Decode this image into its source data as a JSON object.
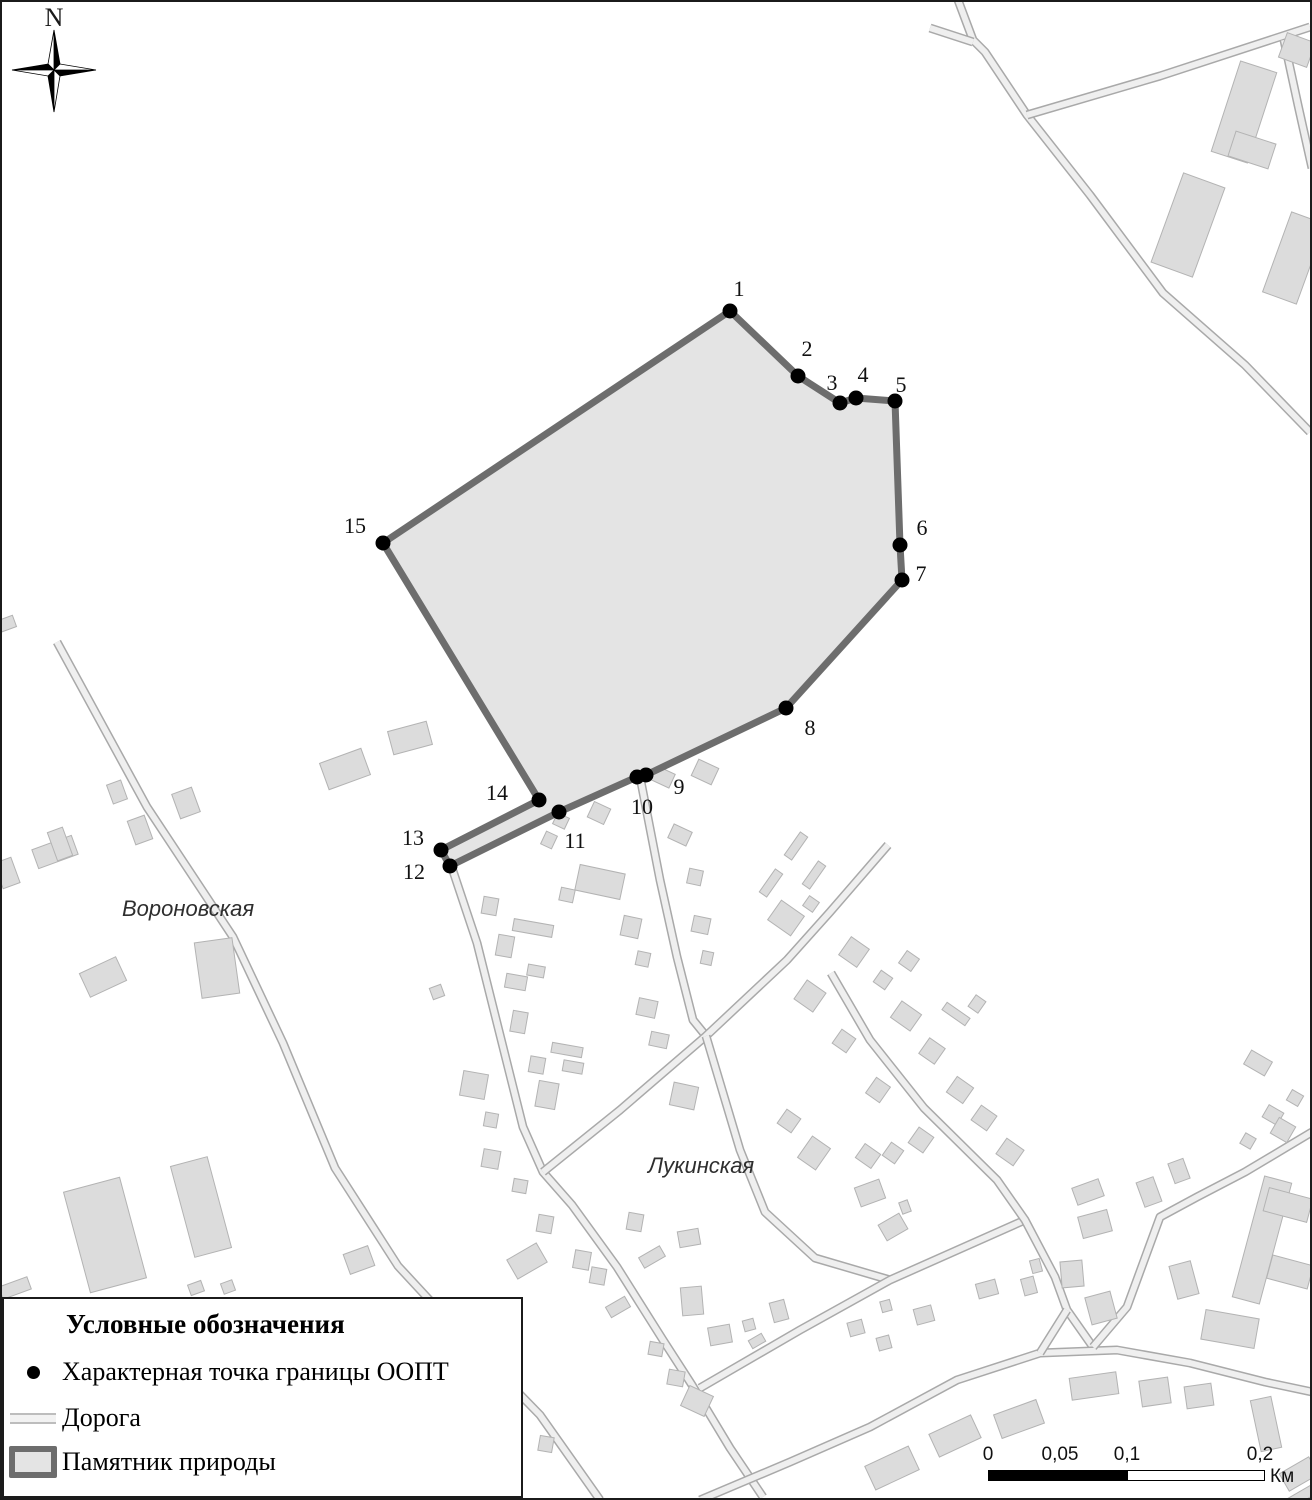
{
  "map": {
    "compass_label": "N",
    "colors": {
      "area_fill": "#e4e4e4",
      "area_stroke": "#6d6d6d",
      "road_casing": "#a9a9a9",
      "road_fill": "#efefef",
      "building_fill": "#dcdcdc",
      "building_stroke": "#b3b3b3",
      "point_dot": "#000000"
    },
    "street_labels": [
      {
        "text": "Вороновская",
        "x": 122,
        "y": 916
      },
      {
        "text": "Лукинская",
        "x": 648,
        "y": 1173
      }
    ],
    "boundary_points": [
      {
        "n": "1",
        "x": 730,
        "y": 311,
        "lx": 739,
        "ly": 296
      },
      {
        "n": "2",
        "x": 798,
        "y": 376,
        "lx": 807,
        "ly": 356
      },
      {
        "n": "3",
        "x": 840,
        "y": 403,
        "lx": 832,
        "ly": 390
      },
      {
        "n": "4",
        "x": 856,
        "y": 398,
        "lx": 863,
        "ly": 382
      },
      {
        "n": "5",
        "x": 895,
        "y": 401,
        "lx": 901,
        "ly": 392
      },
      {
        "n": "6",
        "x": 900,
        "y": 545,
        "lx": 922,
        "ly": 535
      },
      {
        "n": "7",
        "x": 902,
        "y": 580,
        "lx": 921,
        "ly": 581
      },
      {
        "n": "8",
        "x": 786,
        "y": 708,
        "lx": 810,
        "ly": 735
      },
      {
        "n": "9",
        "x": 646,
        "y": 775,
        "lx": 679,
        "ly": 794
      },
      {
        "n": "10",
        "x": 637,
        "y": 777,
        "lx": 642,
        "ly": 814
      },
      {
        "n": "11",
        "x": 559,
        "y": 812,
        "lx": 575,
        "ly": 848
      },
      {
        "n": "12",
        "x": 450,
        "y": 866,
        "lx": 414,
        "ly": 879
      },
      {
        "n": "13",
        "x": 441,
        "y": 850,
        "lx": 413,
        "ly": 845
      },
      {
        "n": "14",
        "x": 539,
        "y": 800,
        "lx": 497,
        "ly": 800
      },
      {
        "n": "15",
        "x": 383,
        "y": 543,
        "lx": 355,
        "ly": 533
      }
    ],
    "roads": [
      [
        [
          958,
          0
        ],
        [
          973,
          40
        ],
        [
          985,
          52
        ],
        [
          1027,
          115
        ],
        [
          1090,
          195
        ],
        [
          1163,
          293
        ],
        [
          1245,
          365
        ],
        [
          1310,
          432
        ]
      ],
      [
        [
          930,
          28
        ],
        [
          973,
          42
        ]
      ],
      [
        [
          1027,
          115
        ],
        [
          1160,
          76
        ],
        [
          1310,
          27
        ]
      ],
      [
        [
          1284,
          40
        ],
        [
          1298,
          105
        ],
        [
          1312,
          168
        ]
      ],
      [
        [
          57,
          642
        ],
        [
          147,
          807
        ],
        [
          233,
          937
        ],
        [
          283,
          1043
        ],
        [
          335,
          1168
        ],
        [
          398,
          1266
        ],
        [
          460,
          1333
        ],
        [
          540,
          1415
        ],
        [
          600,
          1500
        ]
      ],
      [
        [
          452,
          868
        ],
        [
          477,
          943
        ],
        [
          503,
          1047
        ],
        [
          523,
          1127
        ],
        [
          543,
          1172
        ],
        [
          572,
          1205
        ],
        [
          617,
          1267
        ],
        [
          663,
          1340
        ],
        [
          692,
          1385
        ],
        [
          730,
          1448
        ],
        [
          763,
          1497
        ]
      ],
      [
        [
          641,
          782
        ],
        [
          660,
          880
        ],
        [
          677,
          957
        ],
        [
          693,
          1020
        ],
        [
          706,
          1036
        ]
      ],
      [
        [
          888,
          845
        ],
        [
          830,
          912
        ],
        [
          787,
          960
        ],
        [
          706,
          1036
        ],
        [
          620,
          1110
        ],
        [
          543,
          1172
        ]
      ],
      [
        [
          706,
          1036
        ],
        [
          740,
          1150
        ],
        [
          765,
          1212
        ],
        [
          815,
          1258
        ],
        [
          890,
          1280
        ]
      ],
      [
        [
          700,
          1388
        ],
        [
          800,
          1330
        ],
        [
          890,
          1280
        ],
        [
          953,
          1252
        ],
        [
          1025,
          1220
        ]
      ],
      [
        [
          831,
          973
        ],
        [
          870,
          1040
        ],
        [
          924,
          1108
        ],
        [
          997,
          1180
        ],
        [
          1025,
          1220
        ],
        [
          1055,
          1277
        ],
        [
          1067,
          1310
        ],
        [
          1093,
          1347
        ]
      ],
      [
        [
          700,
          1500
        ],
        [
          790,
          1462
        ],
        [
          870,
          1427
        ],
        [
          957,
          1380
        ],
        [
          1040,
          1353
        ],
        [
          1117,
          1350
        ],
        [
          1190,
          1363
        ],
        [
          1265,
          1382
        ],
        [
          1312,
          1392
        ]
      ],
      [
        [
          1067,
          1310
        ],
        [
          1040,
          1353
        ]
      ],
      [
        [
          1093,
          1347
        ],
        [
          1127,
          1307
        ],
        [
          1160,
          1217
        ],
        [
          1197,
          1197
        ],
        [
          1245,
          1172
        ],
        [
          1312,
          1132
        ]
      ]
    ],
    "buildings": [
      [
        1244,
        112,
        38,
        95,
        18
      ],
      [
        1252,
        150,
        42,
        26,
        18
      ],
      [
        1188,
        225,
        44,
        95,
        20
      ],
      [
        1294,
        258,
        36,
        85,
        20
      ],
      [
        1297,
        50,
        30,
        26,
        20
      ],
      [
        6,
        624,
        18,
        12,
        -20
      ],
      [
        55,
        852,
        42,
        20,
        -20
      ],
      [
        60,
        844,
        16,
        30,
        -20
      ],
      [
        117,
        792,
        15,
        20,
        -20
      ],
      [
        140,
        830,
        18,
        25,
        -20
      ],
      [
        186,
        803,
        21,
        26,
        -20
      ],
      [
        103,
        977,
        40,
        26,
        -25
      ],
      [
        217,
        968,
        38,
        56,
        -8
      ],
      [
        345,
        769,
        44,
        28,
        -20
      ],
      [
        410,
        738,
        40,
        24,
        -15
      ],
      [
        7,
        873,
        18,
        27,
        -20
      ],
      [
        105,
        1235,
        58,
        104,
        -15
      ],
      [
        201,
        1207,
        38,
        94,
        -15
      ],
      [
        359,
        1260,
        26,
        21,
        -20
      ],
      [
        15,
        1288,
        30,
        13,
        -20
      ],
      [
        196,
        1288,
        14,
        11,
        -20
      ],
      [
        228,
        1287,
        12,
        11,
        -20
      ],
      [
        437,
        992,
        12,
        12,
        -20
      ],
      [
        600,
        882,
        46,
        26,
        12
      ],
      [
        567,
        895,
        14,
        13,
        12
      ],
      [
        490,
        906,
        15,
        17,
        10
      ],
      [
        533,
        928,
        40,
        12,
        10
      ],
      [
        505,
        946,
        16,
        21,
        10
      ],
      [
        631,
        927,
        18,
        20,
        12
      ],
      [
        643,
        959,
        13,
        14,
        12
      ],
      [
        516,
        982,
        21,
        14,
        10
      ],
      [
        536,
        971,
        17,
        11,
        10
      ],
      [
        519,
        1022,
        15,
        21,
        10
      ],
      [
        537,
        1065,
        15,
        16,
        10
      ],
      [
        567,
        1050,
        31,
        10,
        10
      ],
      [
        573,
        1067,
        20,
        11,
        10
      ],
      [
        547,
        1095,
        20,
        26,
        10
      ],
      [
        474,
        1085,
        25,
        25,
        10
      ],
      [
        491,
        1120,
        13,
        14,
        10
      ],
      [
        491,
        1159,
        17,
        18,
        10
      ],
      [
        520,
        1186,
        14,
        13,
        10
      ],
      [
        647,
        1008,
        19,
        17,
        12
      ],
      [
        659,
        1040,
        18,
        14,
        12
      ],
      [
        684,
        1096,
        25,
        23,
        12
      ],
      [
        695,
        877,
        14,
        15,
        12
      ],
      [
        701,
        925,
        17,
        16,
        12
      ],
      [
        707,
        958,
        11,
        13,
        12
      ],
      [
        663,
        777,
        20,
        15,
        25
      ],
      [
        705,
        772,
        22,
        18,
        25
      ],
      [
        599,
        813,
        18,
        17,
        25
      ],
      [
        561,
        821,
        13,
        12,
        25
      ],
      [
        549,
        840,
        12,
        14,
        25
      ],
      [
        680,
        835,
        20,
        15,
        25
      ],
      [
        796,
        846,
        9,
        28,
        35
      ],
      [
        771,
        883,
        9,
        28,
        35
      ],
      [
        814,
        875,
        9,
        28,
        35
      ],
      [
        786,
        918,
        28,
        24,
        35
      ],
      [
        811,
        904,
        12,
        12,
        35
      ],
      [
        854,
        952,
        22,
        22,
        35
      ],
      [
        810,
        996,
        23,
        23,
        35
      ],
      [
        909,
        961,
        15,
        15,
        35
      ],
      [
        883,
        980,
        14,
        14,
        35
      ],
      [
        906,
        1016,
        24,
        20,
        35
      ],
      [
        956,
        1014,
        28,
        9,
        35
      ],
      [
        977,
        1004,
        12,
        14,
        35
      ],
      [
        844,
        1041,
        17,
        17,
        35
      ],
      [
        932,
        1051,
        19,
        19,
        35
      ],
      [
        960,
        1090,
        20,
        19,
        35
      ],
      [
        984,
        1118,
        19,
        18,
        35
      ],
      [
        878,
        1090,
        17,
        19,
        35
      ],
      [
        789,
        1121,
        17,
        17,
        35
      ],
      [
        814,
        1153,
        22,
        26,
        35
      ],
      [
        868,
        1156,
        19,
        17,
        35
      ],
      [
        893,
        1153,
        15,
        16,
        35
      ],
      [
        921,
        1140,
        18,
        19,
        35
      ],
      [
        1010,
        1152,
        21,
        19,
        35
      ],
      [
        1258,
        1063,
        24,
        16,
        30
      ],
      [
        1273,
        1115,
        17,
        14,
        30
      ],
      [
        1283,
        1130,
        19,
        18,
        30
      ],
      [
        1295,
        1098,
        13,
        12,
        30
      ],
      [
        1248,
        1141,
        12,
        12,
        30
      ],
      [
        870,
        1193,
        26,
        20,
        -20
      ],
      [
        893,
        1227,
        24,
        18,
        -30
      ],
      [
        905,
        1207,
        9,
        12,
        -20
      ],
      [
        987,
        1289,
        20,
        15,
        -15
      ],
      [
        1029,
        1286,
        13,
        17,
        -15
      ],
      [
        1036,
        1266,
        10,
        13,
        -15
      ],
      [
        1072,
        1274,
        22,
        26,
        -5
      ],
      [
        924,
        1315,
        18,
        16,
        -15
      ],
      [
        886,
        1306,
        10,
        11,
        -15
      ],
      [
        856,
        1328,
        15,
        14,
        -15
      ],
      [
        884,
        1343,
        13,
        13,
        -15
      ],
      [
        1088,
        1192,
        28,
        18,
        -20
      ],
      [
        1095,
        1224,
        30,
        22,
        -15
      ],
      [
        1184,
        1280,
        22,
        34,
        -15
      ],
      [
        1230,
        1329,
        54,
        30,
        10
      ],
      [
        1101,
        1308,
        26,
        28,
        -15
      ],
      [
        1149,
        1192,
        18,
        26,
        -20
      ],
      [
        1179,
        1171,
        16,
        21,
        -20
      ],
      [
        1262,
        1240,
        28,
        125,
        15
      ],
      [
        1288,
        1205,
        45,
        24,
        15
      ],
      [
        1290,
        1272,
        42,
        24,
        15
      ],
      [
        892,
        1468,
        48,
        26,
        -25
      ],
      [
        955,
        1436,
        46,
        25,
        -25
      ],
      [
        1019,
        1419,
        45,
        25,
        -20
      ],
      [
        1094,
        1386,
        47,
        22,
        -8
      ],
      [
        1155,
        1392,
        29,
        26,
        -8
      ],
      [
        1199,
        1396,
        27,
        22,
        -8
      ],
      [
        1266,
        1424,
        21,
        52,
        -12
      ],
      [
        1299,
        1474,
        34,
        20,
        -30
      ],
      [
        1302,
        1496,
        40,
        10,
        -30
      ],
      [
        545,
        1224,
        15,
        17,
        10
      ],
      [
        527,
        1261,
        34,
        22,
        -30
      ],
      [
        582,
        1260,
        16,
        18,
        10
      ],
      [
        598,
        1276,
        15,
        16,
        10
      ],
      [
        635,
        1222,
        15,
        17,
        10
      ],
      [
        618,
        1307,
        22,
        12,
        -30
      ],
      [
        652,
        1257,
        24,
        12,
        -30
      ],
      [
        689,
        1238,
        21,
        16,
        -10
      ],
      [
        692,
        1301,
        21,
        28,
        -5
      ],
      [
        720,
        1335,
        22,
        18,
        -10
      ],
      [
        656,
        1349,
        14,
        13,
        10
      ],
      [
        676,
        1378,
        16,
        15,
        10
      ],
      [
        697,
        1401,
        26,
        22,
        25
      ],
      [
        779,
        1311,
        15,
        20,
        -15
      ],
      [
        749,
        1325,
        11,
        11,
        -15
      ],
      [
        757,
        1341,
        15,
        9,
        -30
      ],
      [
        546,
        1444,
        14,
        15,
        10
      ]
    ]
  },
  "legend": {
    "title": "Условные обозначения",
    "items": [
      {
        "symbol": "boundary-point",
        "label": "Характерная точка границы ООПТ"
      },
      {
        "symbol": "road",
        "label": "Дорога"
      },
      {
        "symbol": "nature-monument-area",
        "label": "Памятник природы"
      }
    ]
  },
  "scalebar": {
    "ticks": [
      {
        "label": "0",
        "offset": 0
      },
      {
        "label": "0,05",
        "offset": 72
      },
      {
        "label": "0,1",
        "offset": 139
      },
      {
        "label": "0,2",
        "offset": 272
      }
    ],
    "unit": "Км"
  }
}
